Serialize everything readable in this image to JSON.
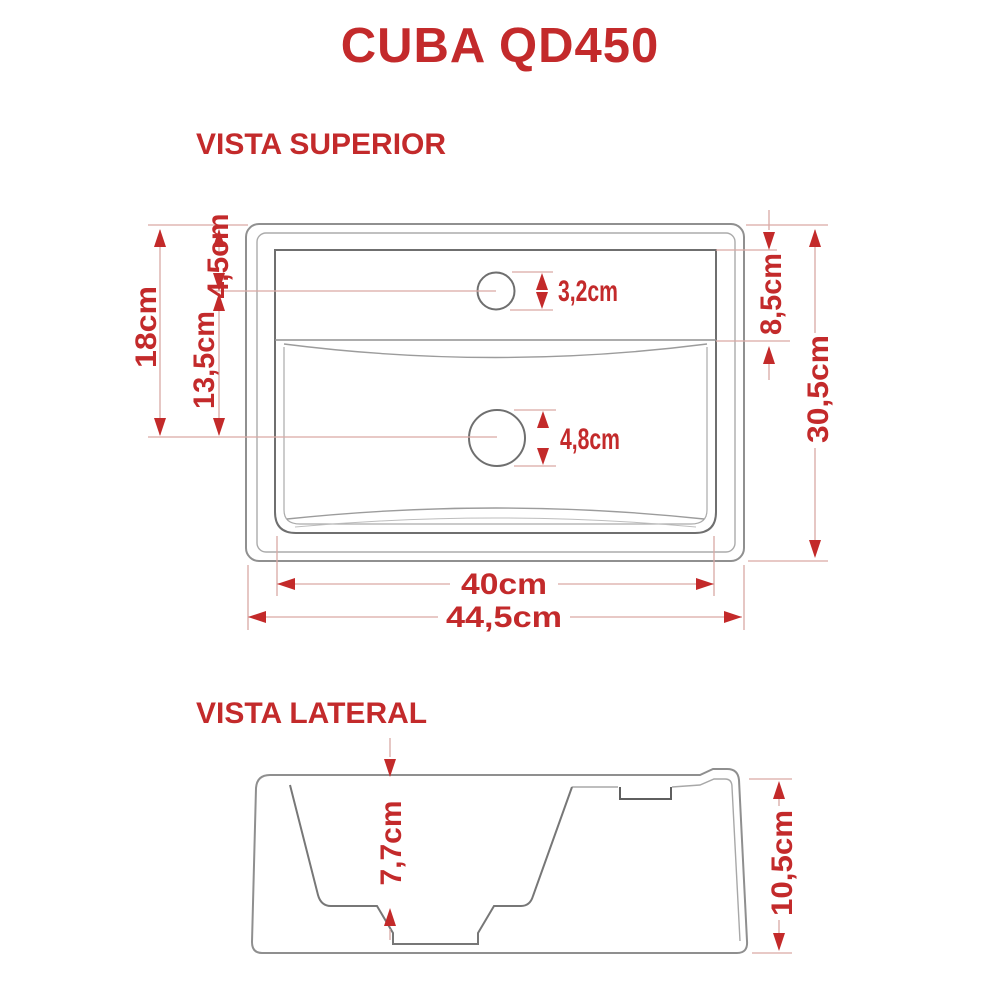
{
  "page": {
    "title": "CUBA QD450"
  },
  "colors": {
    "accent_red": "#c32a2b",
    "line_gray": "#8f8f8f",
    "dark_gray": "#6f6f6f",
    "dim_pink": "#d9a9a5",
    "background": "#ffffff"
  },
  "top_view": {
    "label": "VISTA SUPERIOR",
    "dims": {
      "overall_height": "18cm",
      "faucet_center_offset": "4,5cm",
      "faucet_to_drain": "13,5cm",
      "faucet_hole_diameter": "3,2cm",
      "drain_hole_diameter": "4,8cm",
      "deck_depth": "8,5cm",
      "overall_depth": "30,5cm",
      "basin_width": "40cm",
      "overall_width": "44,5cm"
    }
  },
  "side_view": {
    "label": "VISTA LATERAL",
    "dims": {
      "basin_depth": "7,7cm",
      "overall_height": "10,5cm"
    }
  }
}
